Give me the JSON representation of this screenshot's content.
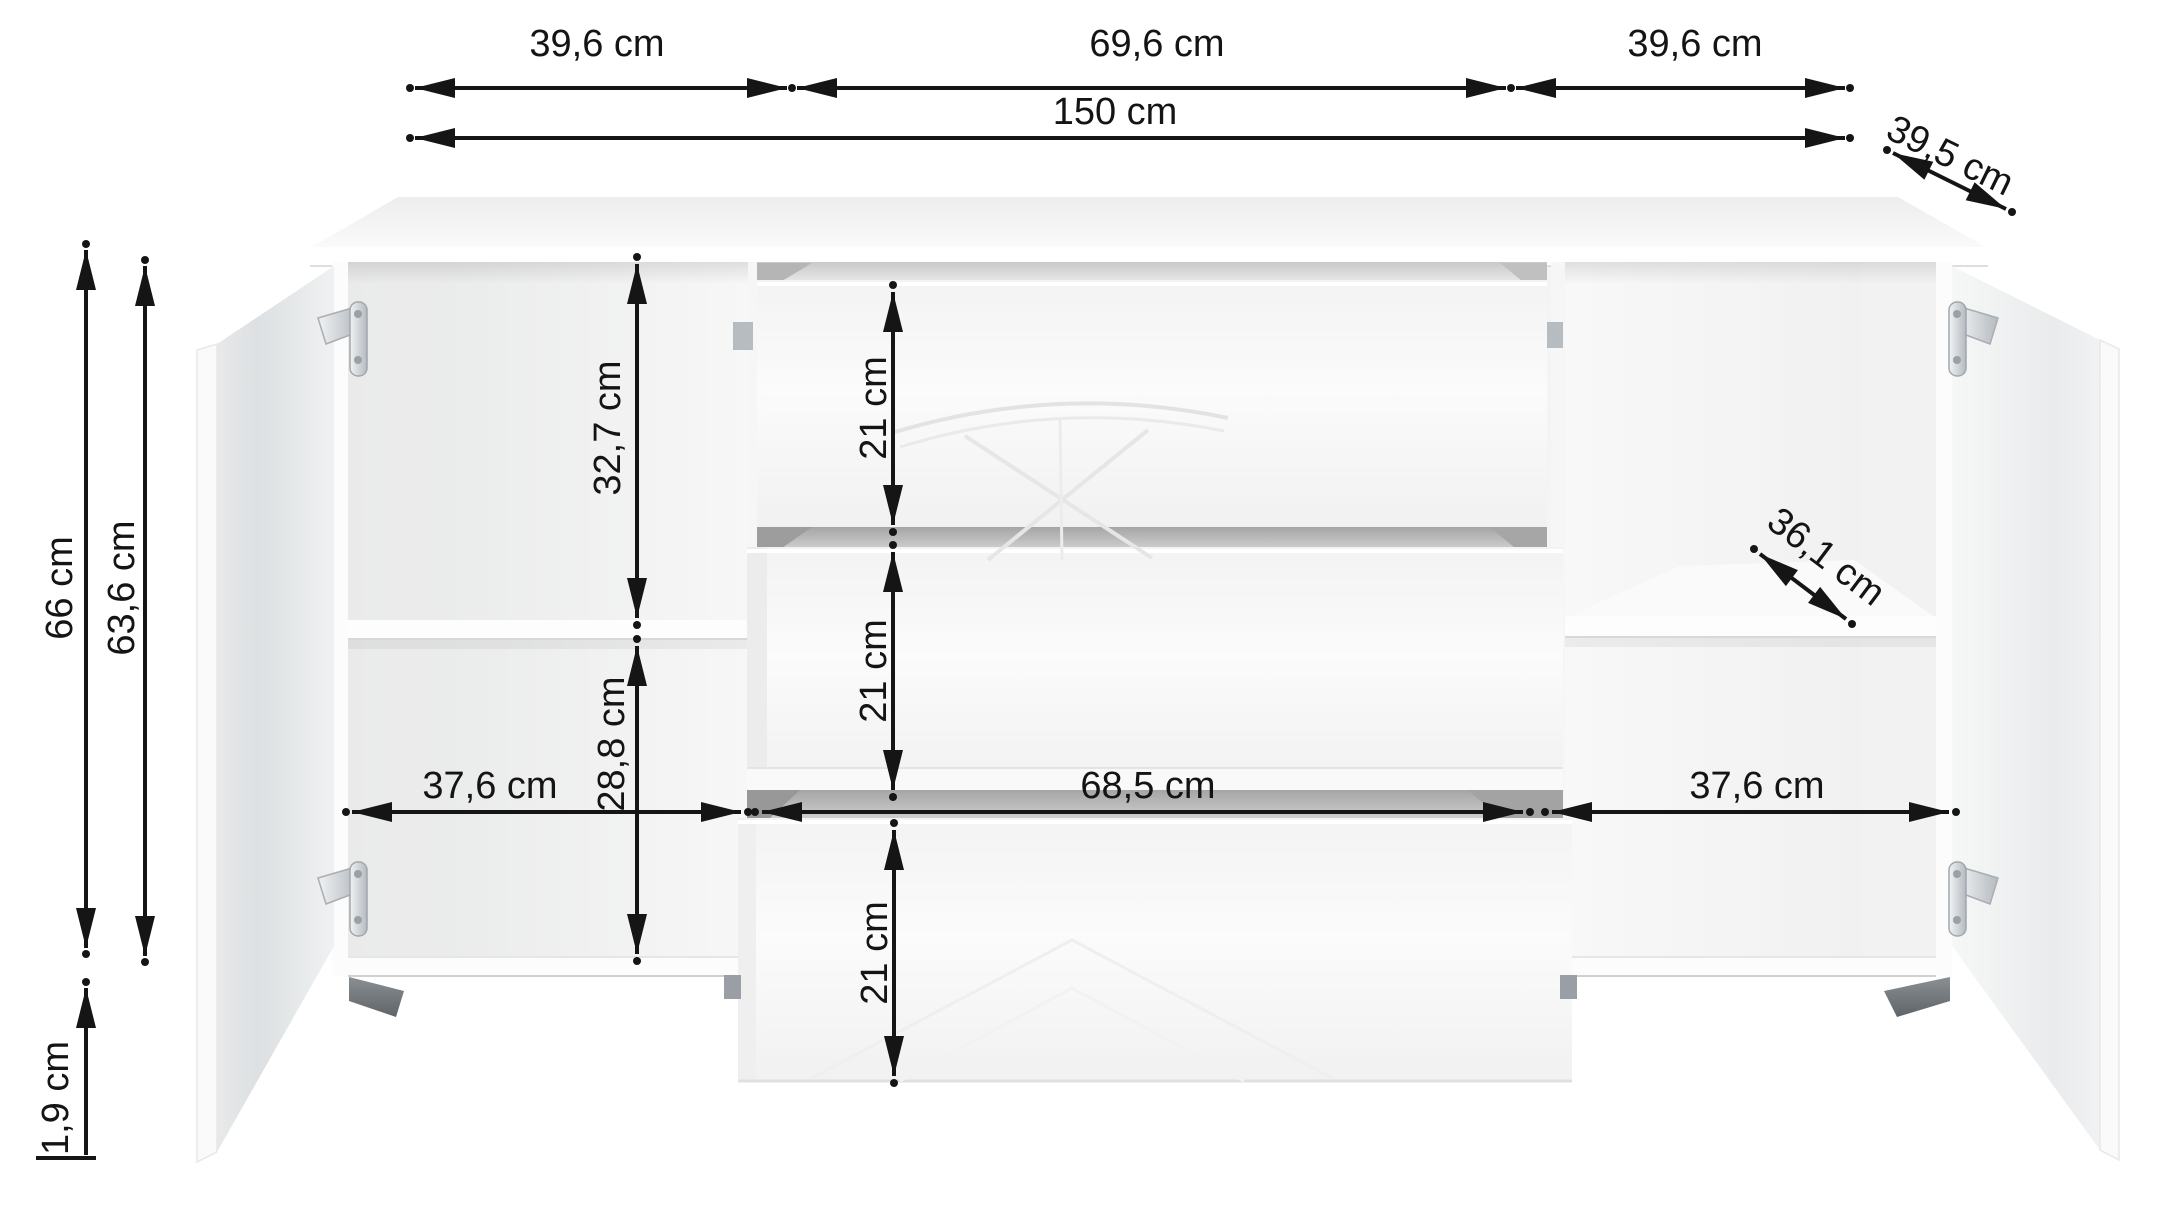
{
  "diagram": {
    "kind": "furniture-dimension-diagram",
    "subject": "sideboard with two open doors and three drawers",
    "unit": "cm"
  },
  "palette": {
    "line": "#151515",
    "text": "#141414",
    "door_gray": "#e3e6e8",
    "gap_gray": "#a9a9a9",
    "chrome": "#c8cdd1",
    "background": "#ffffff"
  },
  "labels": {
    "width_left": "39,6 cm",
    "width_center": "69,6 cm",
    "width_right": "39,6 cm",
    "total_width": "150 cm",
    "depth": "39,5 cm",
    "height_total": "66 cm",
    "height_inner": "63,6 cm",
    "plinth_height": "1,9 cm",
    "left_upper": "32,7 cm",
    "left_lower": "28,8 cm",
    "drawer_top": "21 cm",
    "drawer_middle": "21 cm",
    "drawer_bottom": "21 cm",
    "inner_left": "37,6 cm",
    "inner_center": "68,5 cm",
    "inner_right": "37,6 cm",
    "shelf_depth": "36,1 cm"
  }
}
